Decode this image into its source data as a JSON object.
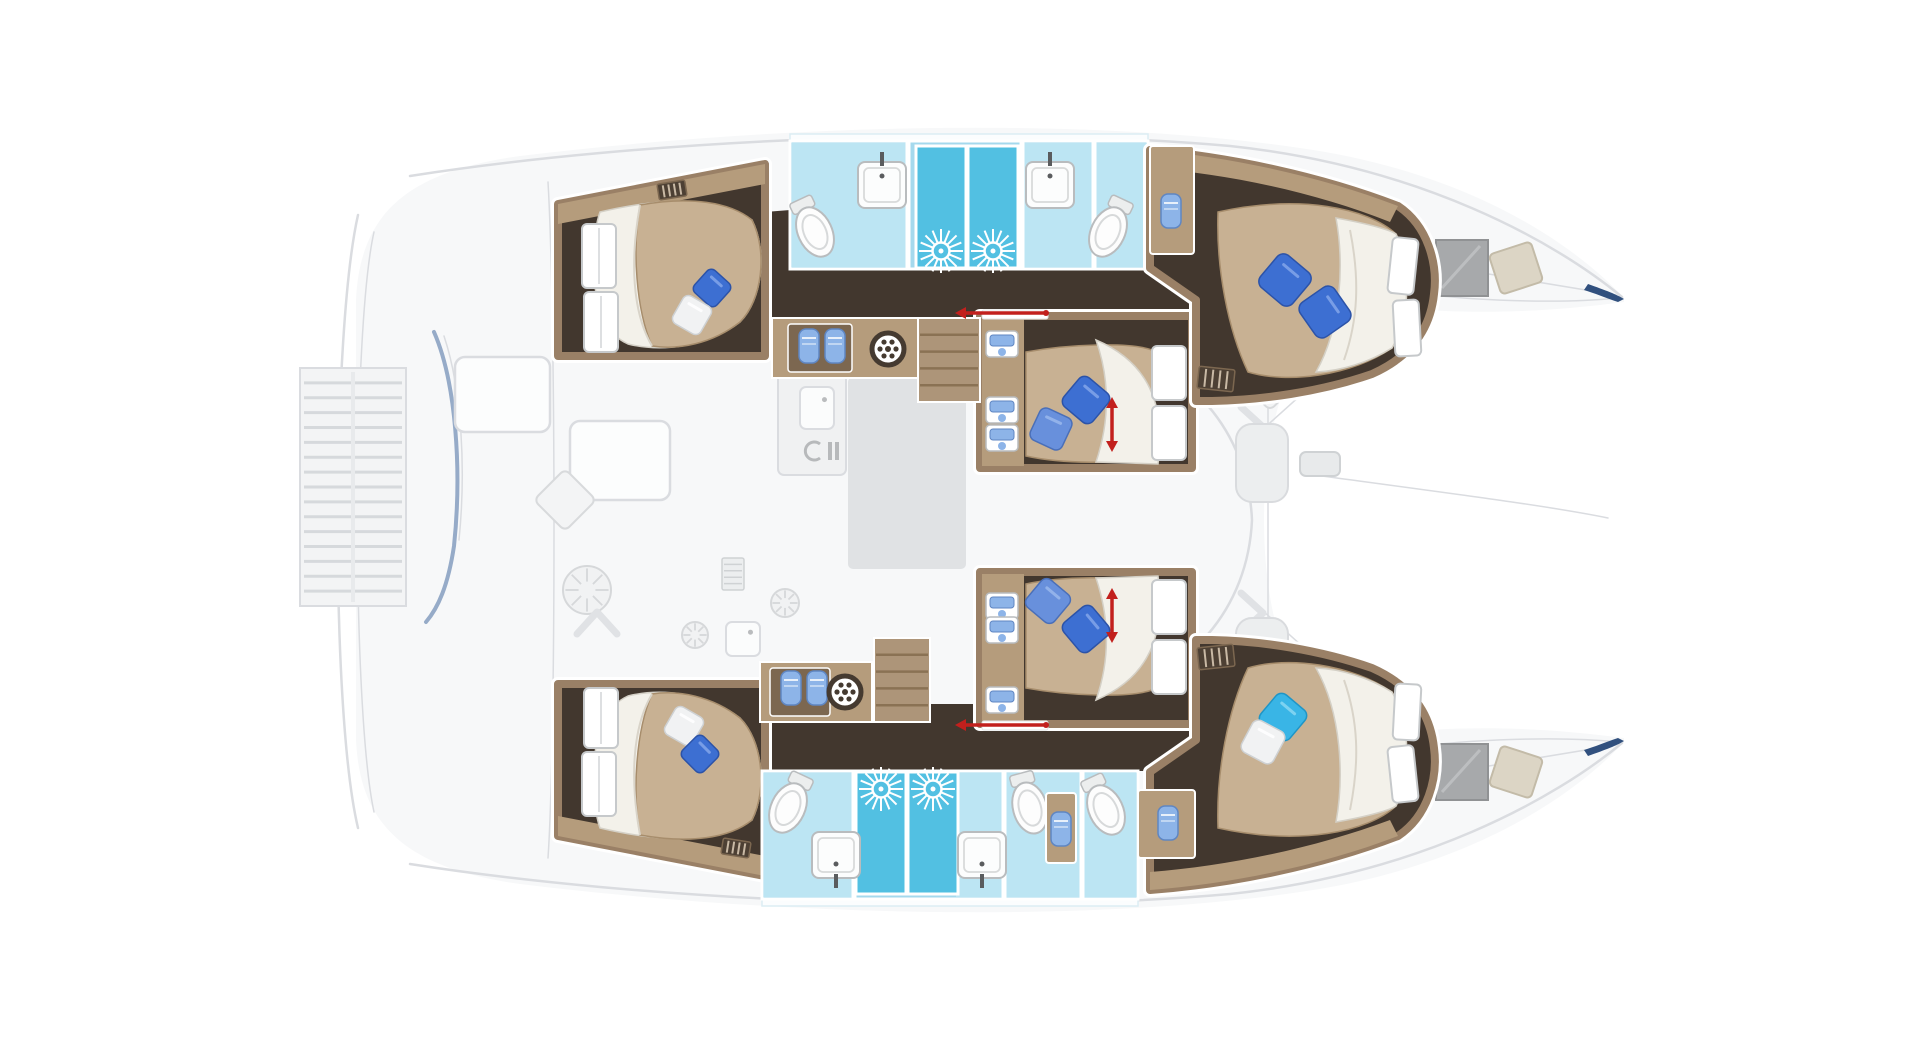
{
  "vessel": {
    "type": "sailing catamaran floor plan",
    "view": "top-down deck and cabin layout",
    "orientation": "bow right, stern left",
    "cabin_count": 6
  },
  "cabins": [
    {
      "id": "hull1-aft",
      "position": "upper hull aft",
      "bed": "island double",
      "pillow_colors": [
        "blue",
        "white"
      ]
    },
    {
      "id": "hull1-mid",
      "position": "upper hull midship",
      "bed": "double",
      "pillow_colors": [
        "blue",
        "blue"
      ],
      "marker": "red double arrow"
    },
    {
      "id": "hull1-fwd",
      "position": "upper hull forward",
      "bed": "island double",
      "pillow_colors": [
        "blue",
        "blue"
      ]
    },
    {
      "id": "hull2-aft",
      "position": "lower hull aft",
      "bed": "island double",
      "pillow_colors": [
        "white",
        "blue"
      ]
    },
    {
      "id": "hull2-mid",
      "position": "lower hull midship",
      "bed": "double",
      "pillow_colors": [
        "blue",
        "blue"
      ],
      "marker": "red double arrow"
    },
    {
      "id": "hull2-fwd",
      "position": "lower hull forward",
      "bed": "island double",
      "pillow_colors": [
        "turquoise",
        "white"
      ]
    }
  ],
  "bathrooms": [
    {
      "id": "hull1-aft-head",
      "fixtures": [
        "toilet",
        "washbasin",
        "shower"
      ]
    },
    {
      "id": "hull1-fwd-head",
      "fixtures": [
        "washbasin",
        "shower",
        "toilet"
      ]
    },
    {
      "id": "hull2-aft-head",
      "fixtures": [
        "toilet",
        "washbasin",
        "shower"
      ]
    },
    {
      "id": "hull2-fwd-head",
      "fixtures": [
        "washbasin",
        "shower",
        "toilet",
        "extra WC"
      ]
    }
  ],
  "ghost_areas": [
    "aft swim platform with slats",
    "cockpit with tables and seating",
    "saloon with galley and rug",
    "foredeck seating pods",
    "bow trampoline area",
    "bow deck windows and hatches"
  ],
  "palette": {
    "ghost_fill": "#f7f8f9",
    "ghost_stroke": "#dadce0",
    "ghost_item": "#f0f1f2",
    "rug": "#e0e2e4",
    "wood": "#9a8066",
    "wood_light": "#b59c7c",
    "wood_dark": "#7c6750",
    "floor_dark": "#42372e",
    "bed": "#c8b193",
    "bed_edge": "#a78d6c",
    "sheet": "#f3f1ea",
    "sheet_edge": "#d4d0c6",
    "bath": "#a5d9ed",
    "bath_light": "#bce5f3",
    "shower": "#52c0e2",
    "locker_blue": "#8db4e8",
    "locker_blue_dark": "#5f86c2",
    "red": "#c2201d",
    "navy": "#31507e",
    "davit": "#8ba2c2",
    "window_gray": "#a7a9ab",
    "hatch_beige": "#dcd5c5",
    "pillow": {
      "royal": {
        "fill": "#3d6fd2",
        "stroke": "#2c53a8",
        "hi": "#82a6ea"
      },
      "medium": {
        "fill": "#6890dc",
        "stroke": "#4a6fb8",
        "hi": "#9ab8ec"
      },
      "cyan": {
        "fill": "#39b5e6",
        "stroke": "#1f95c6",
        "hi": "#8ad7f2"
      },
      "white": {
        "fill": "#f1f2f3",
        "stroke": "#ced1d3",
        "hi": "#ffffff"
      }
    }
  },
  "render": {
    "pillows": [
      {
        "cx": 712,
        "cy": 288,
        "s": 30,
        "rot": 42,
        "color": "royal"
      },
      {
        "cx": 692,
        "cy": 315,
        "s": 32,
        "rot": 30,
        "color": "white"
      },
      {
        "cx": 1086,
        "cy": 400,
        "s": 38,
        "rot": 40,
        "color": "royal"
      },
      {
        "cx": 1051,
        "cy": 429,
        "s": 35,
        "rot": 25,
        "color": "medium"
      },
      {
        "cx": 1285,
        "cy": 280,
        "s": 42,
        "rot": 40,
        "color": "royal"
      },
      {
        "cx": 1325,
        "cy": 312,
        "s": 42,
        "rot": 55,
        "color": "royal"
      },
      {
        "cx": 684,
        "cy": 726,
        "s": 32,
        "rot": 30,
        "color": "white"
      },
      {
        "cx": 700,
        "cy": 754,
        "s": 30,
        "rot": 45,
        "color": "royal"
      },
      {
        "cx": 1048,
        "cy": 601,
        "s": 36,
        "rot": 40,
        "color": "medium"
      },
      {
        "cx": 1086,
        "cy": 629,
        "s": 38,
        "rot": 50,
        "color": "royal"
      },
      {
        "cx": 1283,
        "cy": 717,
        "s": 38,
        "rot": 40,
        "color": "cyan"
      },
      {
        "cx": 1263,
        "cy": 742,
        "s": 36,
        "rot": 28,
        "color": "white"
      }
    ],
    "ghost_diamonds": [
      {
        "cx": 565,
        "cy": 500,
        "s": 44
      },
      {
        "cx": 1270,
        "cy": 385,
        "s": 36
      },
      {
        "cx": 1270,
        "cy": 655,
        "s": 36
      }
    ],
    "toilets": [
      {
        "cx": 815,
        "cy": 232,
        "rot": -25
      },
      {
        "cx": 1108,
        "cy": 232,
        "rot": 25
      },
      {
        "cx": 788,
        "cy": 808,
        "rot": 25
      },
      {
        "cx": 1030,
        "cy": 808,
        "rot": -15
      },
      {
        "cx": 1106,
        "cy": 810,
        "rot": -25
      }
    ],
    "sinks": [
      {
        "x": 858,
        "y": 162,
        "w": 48,
        "h": 46,
        "side": "top"
      },
      {
        "x": 1026,
        "y": 162,
        "w": 48,
        "h": 46,
        "side": "top"
      },
      {
        "x": 812,
        "y": 832,
        "w": 48,
        "h": 46,
        "side": "bottom"
      },
      {
        "x": 958,
        "y": 832,
        "w": 48,
        "h": 46,
        "side": "bottom"
      }
    ],
    "showers": [
      {
        "x": 916,
        "y": 146,
        "w": 50,
        "h": 122
      },
      {
        "x": 968,
        "y": 146,
        "w": 50,
        "h": 122
      },
      {
        "x": 856,
        "y": 772,
        "w": 50,
        "h": 122
      },
      {
        "x": 908,
        "y": 772,
        "w": 50,
        "h": 122
      }
    ],
    "sunbursts": [
      {
        "cx": 941,
        "cy": 251
      },
      {
        "cx": 993,
        "cy": 251
      },
      {
        "cx": 881,
        "cy": 789
      },
      {
        "cx": 933,
        "cy": 789
      }
    ],
    "towel_panels": [
      {
        "x": 1150,
        "y": 146,
        "w": 44,
        "h": 108
      },
      {
        "x": 1046,
        "y": 793,
        "w": 30,
        "h": 70
      },
      {
        "x": 1138,
        "y": 790,
        "w": 57,
        "h": 68
      }
    ],
    "towels": [
      {
        "x": 1161,
        "y": 194
      },
      {
        "x": 1051,
        "y": 812
      },
      {
        "x": 1158,
        "y": 806
      },
      {
        "x": 799,
        "y": 329
      },
      {
        "x": 825,
        "y": 329
      },
      {
        "x": 781,
        "y": 671
      },
      {
        "x": 807,
        "y": 671
      }
    ],
    "lockers": [
      {
        "x": 986,
        "y": 331
      },
      {
        "x": 986,
        "y": 397
      },
      {
        "x": 986,
        "y": 425
      },
      {
        "x": 986,
        "y": 593
      },
      {
        "x": 986,
        "y": 617
      },
      {
        "x": 986,
        "y": 687
      }
    ],
    "grilles": [
      {
        "x": 658,
        "y": 182,
        "w": 28,
        "h": 16,
        "rot": -9
      },
      {
        "x": 1198,
        "y": 368,
        "w": 36,
        "h": 22,
        "rot": 6
      },
      {
        "x": 722,
        "y": 840,
        "w": 28,
        "h": 16,
        "rot": 9
      },
      {
        "x": 1198,
        "y": 646,
        "w": 36,
        "h": 22,
        "rot": -6
      }
    ],
    "ghost_grilles": [
      {
        "x": 722,
        "y": 558,
        "w": 22,
        "h": 32
      }
    ],
    "vents": [
      {
        "cx": 888,
        "cy": 349
      },
      {
        "cx": 845,
        "cy": 692
      }
    ],
    "stairs": [
      {
        "x": 918,
        "y": 318,
        "w": 62,
        "h": 84,
        "n": 5
      },
      {
        "x": 874,
        "y": 638,
        "w": 56,
        "h": 84,
        "n": 5
      }
    ],
    "arrows_v": [
      {
        "x": 1112,
        "y1": 397,
        "y2": 452
      },
      {
        "x": 1112,
        "y1": 588,
        "y2": 643
      }
    ],
    "arrows_h": [
      {
        "y": 313,
        "x1": 955,
        "x2": 1046
      },
      {
        "y": 725,
        "x1": 955,
        "x2": 1046
      }
    ],
    "slats": {
      "x": 300,
      "y": 368,
      "w": 106,
      "h": 238,
      "n": 16
    },
    "ghost_tables": [
      {
        "x": 455,
        "y": 357,
        "w": 95,
        "h": 75
      },
      {
        "x": 570,
        "y": 421,
        "w": 100,
        "h": 79
      }
    ],
    "rug": {
      "x": 848,
      "y": 377,
      "w": 118,
      "h": 192
    },
    "ghost_flowers": [
      {
        "cx": 587,
        "cy": 590,
        "r": 24
      },
      {
        "cx": 695,
        "cy": 635,
        "r": 13
      },
      {
        "cx": 785,
        "cy": 603,
        "r": 14
      }
    ],
    "ghost_squares": [
      {
        "x": 726,
        "y": 622,
        "w": 34,
        "h": 34
      },
      {
        "x": 800,
        "y": 387,
        "w": 34,
        "h": 42
      }
    ],
    "ghost_chevrons": [
      {
        "cx": 597,
        "cy": 622,
        "rot": 0
      },
      {
        "cx": 1253,
        "cy": 427,
        "rot": 90
      },
      {
        "cx": 1253,
        "cy": 613,
        "rot": 90
      }
    ],
    "ghost_pods": [
      {
        "x": 1236,
        "y": 424,
        "w": 52,
        "h": 78
      },
      {
        "x": 1236,
        "y": 618,
        "w": 52,
        "h": 78
      }
    ],
    "windlass": {
      "x": 1300,
      "y": 452,
      "w": 40,
      "h": 24
    },
    "bow_windows": [
      {
        "x": 1436,
        "y": 240,
        "w": 52,
        "h": 56
      },
      {
        "x": 1436,
        "y": 744,
        "w": 52,
        "h": 56
      }
    ],
    "bow_hatches": [
      {
        "cx": 1516,
        "cy": 268,
        "w": 44,
        "h": 42,
        "rot": -18
      },
      {
        "cx": 1516,
        "cy": 772,
        "w": 44,
        "h": 42,
        "rot": 18
      }
    ]
  }
}
